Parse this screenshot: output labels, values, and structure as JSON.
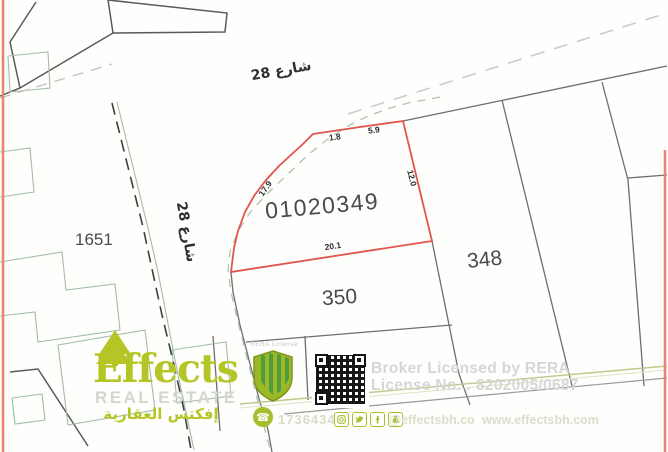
{
  "map": {
    "street_top": "شارع 28",
    "street_left": "شارع 28",
    "plots": {
      "highlight": "01020349",
      "p1651": "1651",
      "p348": "348",
      "p350": "350"
    },
    "measurements": {
      "top_left": "1.8",
      "top_right": "5.9",
      "right": "12.0",
      "left": "17.9",
      "bottom": "20.1"
    }
  },
  "footer": {
    "brand_name": "Effects",
    "brand_subtitle": "REAL ESTATE",
    "brand_arabic": "إفكتس العقارية",
    "badge_caption": "RERA License",
    "broker_line1": "Broker Licensed by RERA",
    "broker_line2": "License No. : 8202005/0687",
    "phone": "17364345",
    "handle": "@effectsbh.co",
    "website": "www.effectsbh.com"
  },
  "colors": {
    "brand_green": "#b4c525",
    "highlight_red": "#e0564c",
    "border_orange": "#e8856c",
    "map_line_gray": "#6e6e6e",
    "watermark_gray": "#d6d6d6"
  }
}
